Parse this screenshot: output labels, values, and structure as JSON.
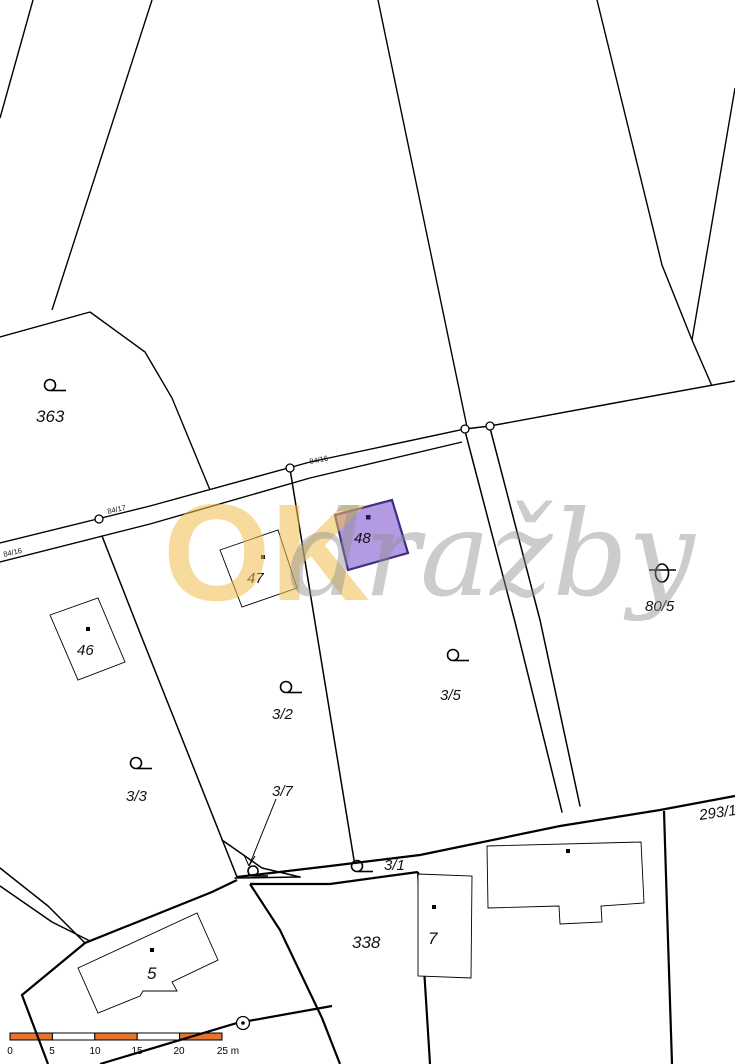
{
  "map": {
    "type_label": "cadastral-parcel-map",
    "background_color": "#ffffff",
    "line_color": "#000000",
    "highlight_parcel": {
      "number": "48",
      "fill_color": "#b49ae2",
      "stroke_color": "#3d2e85"
    },
    "labels": {
      "p363": "363",
      "p46": "46",
      "p47": "47",
      "p48": "48",
      "p3_2": "3/2",
      "p3_3": "3/3",
      "p3_5": "3/5",
      "p3_7": "3/7",
      "p3_1": "3/1",
      "p338": "338",
      "p7": "7",
      "p5": "5",
      "p80_5": "80/5",
      "p293_1": "293/1",
      "road_left": "84/16",
      "road_mid": "84/17",
      "road_top": "84/16"
    },
    "watermark": {
      "part1": "OK",
      "part2": "dražby",
      "part1_color": "#f0bf4e",
      "part2_color": "#8f8f8f"
    },
    "scalebar": {
      "bar_color": "#e5742c",
      "ticks": [
        "0",
        "5",
        "10",
        "15",
        "20",
        "25 m"
      ]
    }
  }
}
